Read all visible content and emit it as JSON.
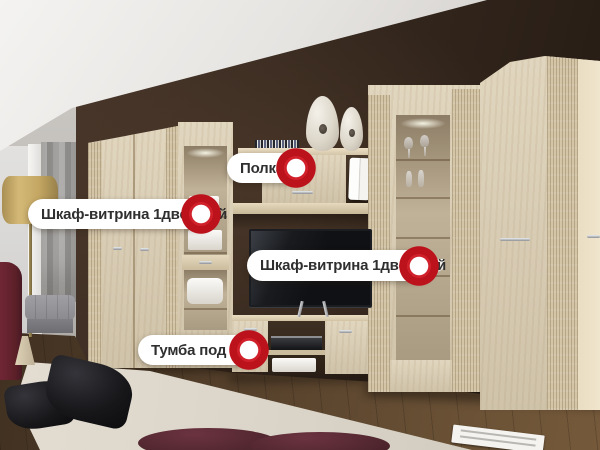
{
  "callouts": [
    {
      "id": "vitrine-left",
      "text": "Шкаф-витрина 1дверный"
    },
    {
      "id": "shelf",
      "text": "Полка"
    },
    {
      "id": "vitrine-right",
      "text": "Шкаф-витрина 1дверный"
    },
    {
      "id": "tv-stand",
      "text": "Тумба под ТВ"
    }
  ],
  "hotspot": {
    "icon": "ring-dot-icon",
    "color": "#bc121c",
    "inner_color": "#ffffff"
  },
  "label_style": {
    "bg": "#ffffff",
    "text_color": "#2f2f2f"
  },
  "palette": {
    "wall_dark": "#36281f",
    "ceiling": "#ece9e6",
    "wood_light": "#dccfb4",
    "floor_wood": "#55402b",
    "carpet": "#dcd6ca",
    "accent_red": "#bc121c"
  }
}
